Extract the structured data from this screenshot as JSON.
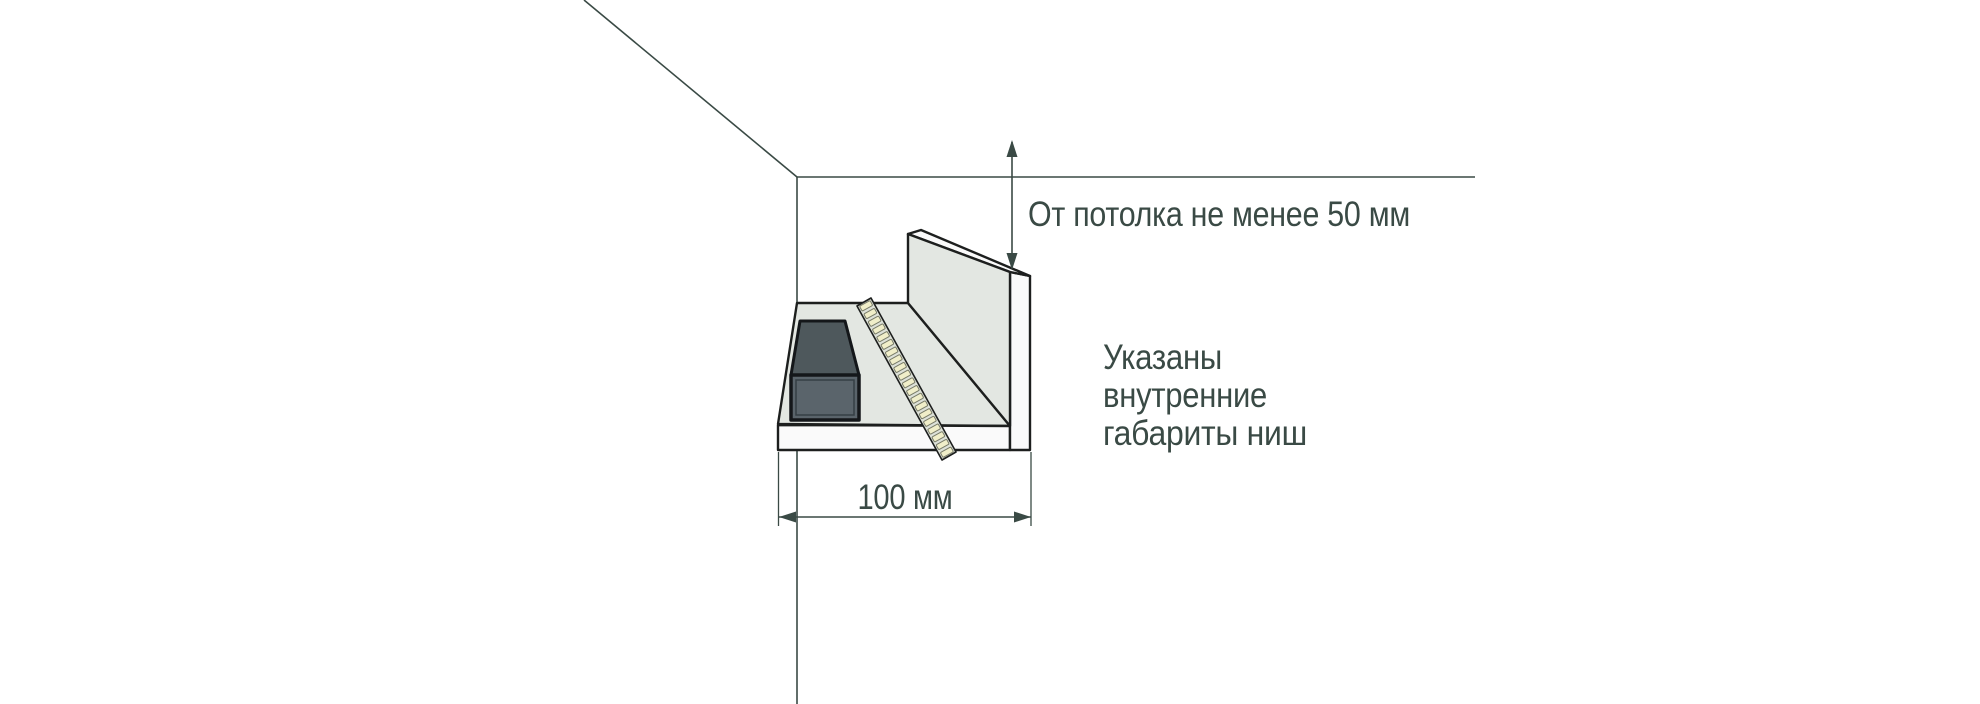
{
  "diagram": {
    "labels": {
      "ceiling_clearance": "От потолка не менее 50 мм",
      "width": "100 мм",
      "note": [
        "Указаны",
        "внутренние",
        "габариты ниш"
      ]
    },
    "dimensions": {
      "ceiling_clearance_min_mm": 50,
      "niche_width_mm": 100
    }
  },
  "led_strip": {
    "segment_count": 20
  },
  "colors": {
    "ink": "#3a4a45",
    "outline": "#1d1f1e",
    "panel": "#e3e7e2",
    "panel_light": "#fafafa",
    "box_top": "#4e585c",
    "box_front": "#5a646b",
    "box_outline": "#14171a",
    "box_inner_line": "#353e44",
    "strip_body": "#dde1d8",
    "led_segment": "#f0eec9",
    "led_outline": "#787b68",
    "background": "#ffffff"
  }
}
